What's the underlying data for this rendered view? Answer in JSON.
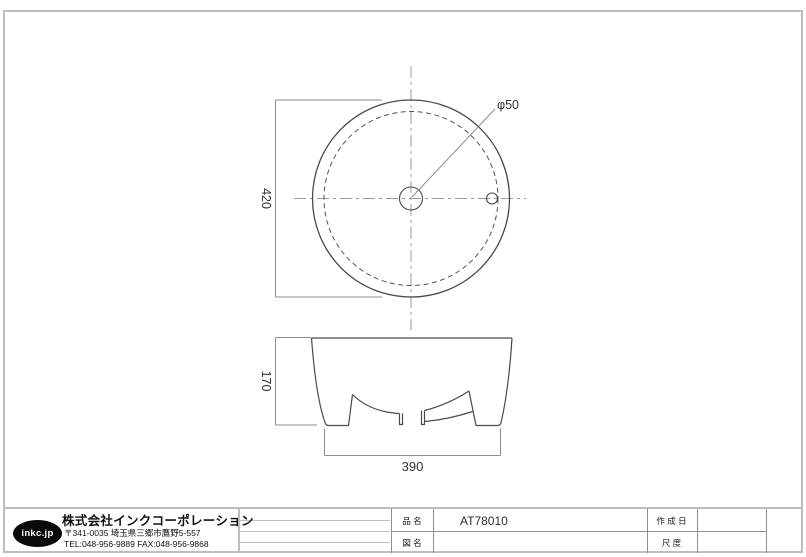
{
  "dimensions": {
    "top_view_diameter": "420",
    "faucet_hole": "φ50",
    "side_view_height": "170",
    "side_view_width": "390"
  },
  "title_block": {
    "logo": "inkc.jp",
    "company_name": "株式会社インクコーポレーション",
    "address": "〒341-0035 埼玉県三郷市鷹野5-557",
    "tel_fax": "TEL:048-956-9889  FAX:048-956-9868",
    "fields": {
      "product_label": "品 名",
      "product_value": "AT78010",
      "drawing_name_label": "図 名",
      "drawing_name_value": "",
      "created_date_label": "作 成 日",
      "created_date_value": "",
      "scale_label": "尺 度",
      "scale_value": ""
    }
  },
  "colors": {
    "object_line": "#4a4a4a",
    "dimension_line": "#8e8e8e",
    "center_line": "#9a9a9a",
    "frame_border": "#bdbdbd",
    "logo_bg": "#0a0a0a"
  }
}
